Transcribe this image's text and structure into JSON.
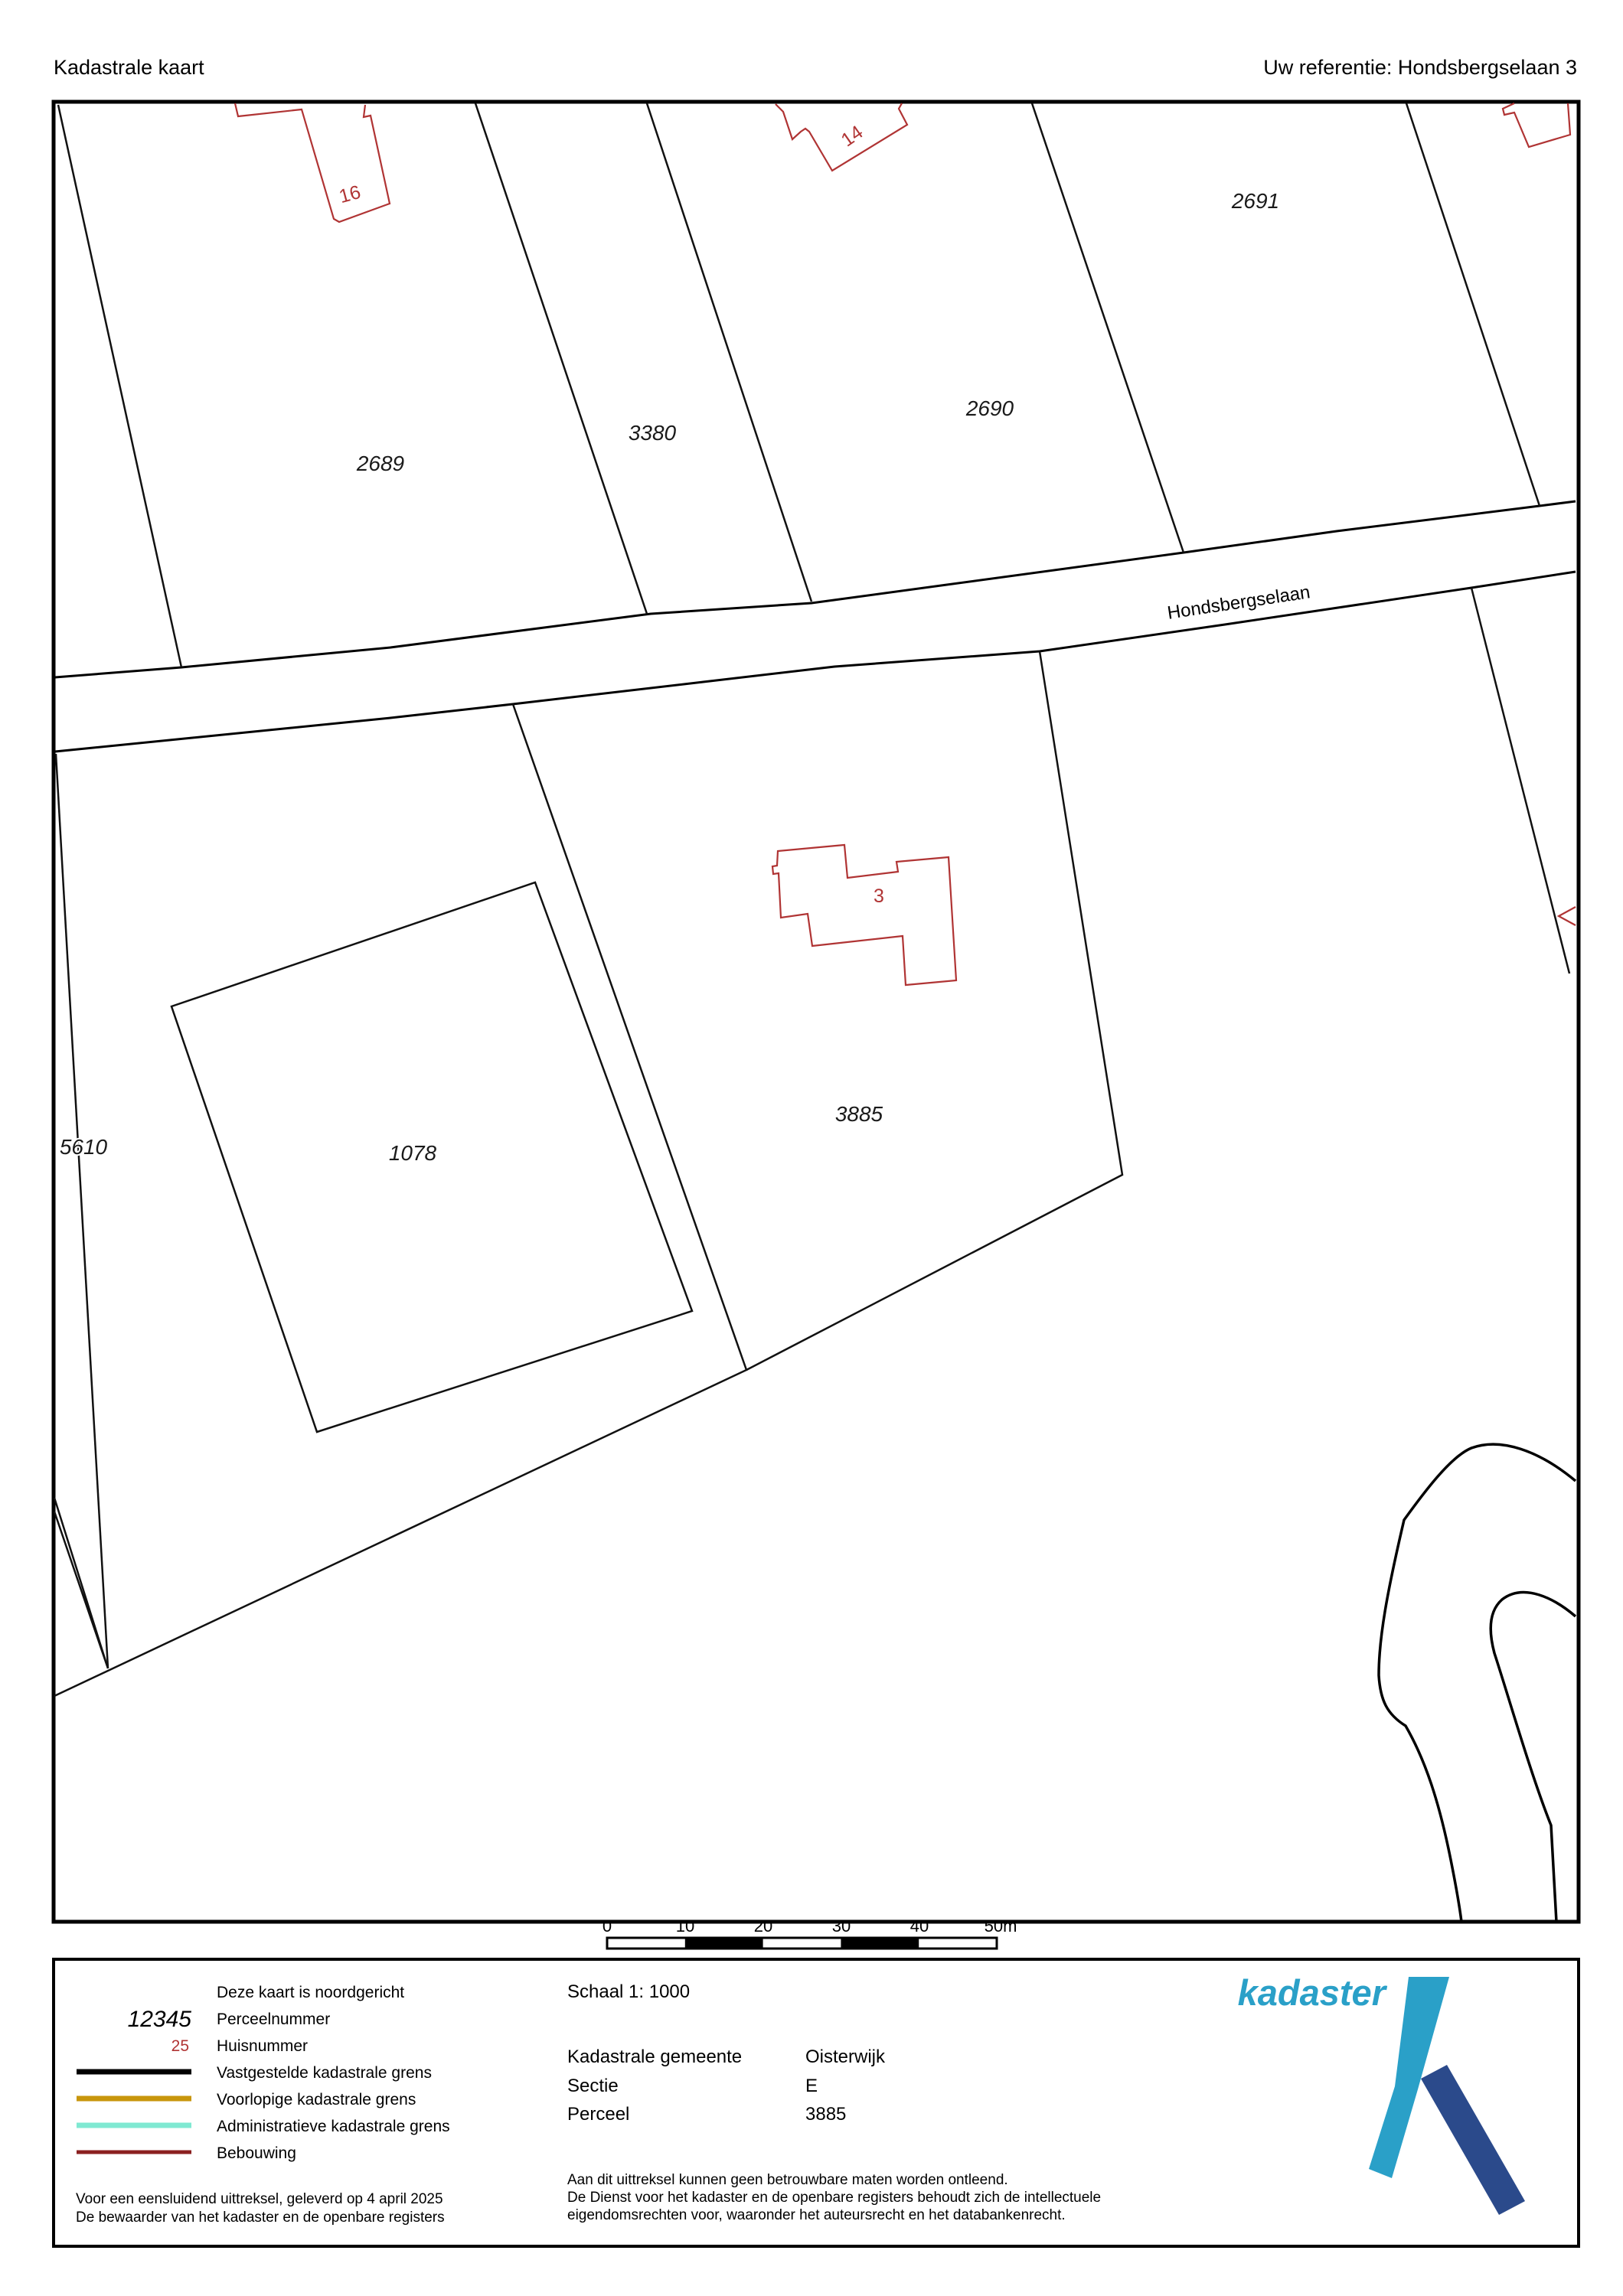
{
  "header": {
    "title": "Kadastrale kaart",
    "reference": "Uw referentie: Hondsbergselaan 3"
  },
  "map": {
    "road_name": "Hondsbergselaan",
    "parcels": [
      {
        "number": "2689"
      },
      {
        "number": "3380"
      },
      {
        "number": "2690"
      },
      {
        "number": "2691"
      },
      {
        "number": "5610"
      },
      {
        "number": "1078"
      },
      {
        "number": "3885"
      }
    ],
    "house_numbers": [
      {
        "number": "16"
      },
      {
        "number": "14"
      },
      {
        "number": "3"
      }
    ]
  },
  "scalebar": {
    "ticks": [
      "0",
      "10",
      "20",
      "30",
      "40",
      "50m"
    ]
  },
  "legend": {
    "north_note": "Deze kaart is noordgericht",
    "parcel_sample": "12345",
    "parcel_label": "Perceelnummer",
    "house_sample": "25",
    "house_label": "Huisnummer",
    "line1_label": "Vastgestelde kadastrale grens",
    "line2_label": "Voorlopige kadastrale grens",
    "line3_label": "Administratieve kadastrale grens",
    "line4_label": "Bebouwing",
    "footer_line1": "Voor een eensluidend uittreksel, geleverd op 4 april 2025",
    "footer_line2": "De bewaarder van het kadaster en de openbare registers",
    "scale_text": "Schaal 1: 1000",
    "gemeente_label": "Kadastrale gemeente",
    "gemeente_value": "Oisterwijk",
    "sectie_label": "Sectie",
    "sectie_value": "E",
    "perceel_label": "Perceel",
    "perceel_value": "3885",
    "disclaimer_line1": "Aan dit uittreksel kunnen geen betrouwbare maten worden ontleend.",
    "disclaimer_line2": "De Dienst voor het kadaster en de openbare registers behoudt zich de intellectuele",
    "disclaimer_line3": "eigendomsrechten voor, waaronder het auteursrecht en het databankenrecht."
  },
  "logo": {
    "word": "kadaster"
  },
  "colors": {
    "ink": "#000000",
    "building": "#b03434",
    "housenr": "#b03434",
    "ochre": "#c8960c",
    "turquoise": "#7fe9d2",
    "bebouwing": "#8b2020",
    "logo-light": "#2aa0c8",
    "logo-dark": "#2b4a8b"
  }
}
